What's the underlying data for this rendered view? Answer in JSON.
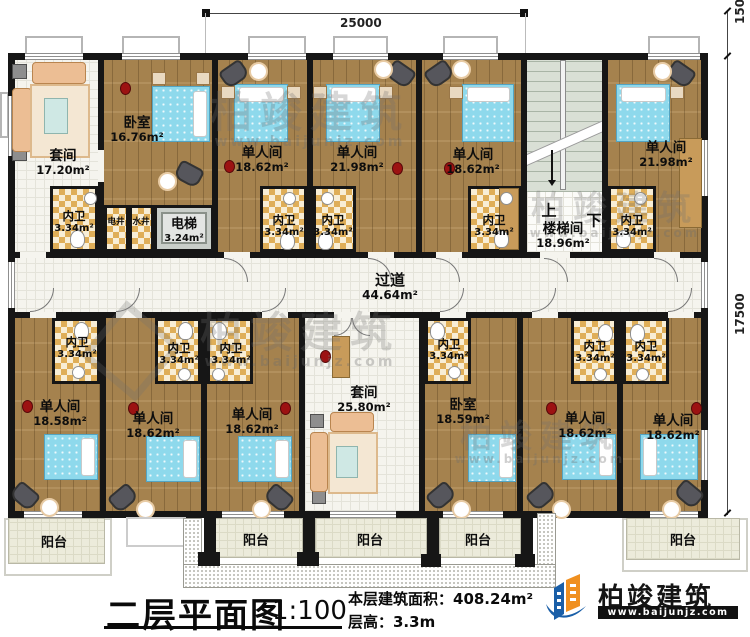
{
  "dims": {
    "width": "25000",
    "right_top": "1500",
    "right_side": "17500"
  },
  "rooms": [
    {
      "name": "套间",
      "area": "17.20m²"
    },
    {
      "name": "卧室",
      "area": "16.76m²"
    },
    {
      "name": "单人间",
      "area": "18.62m²"
    },
    {
      "name": "单人间",
      "area": "21.98m²"
    },
    {
      "name": "单人间",
      "area": "18.62m²"
    },
    {
      "name": "楼梯间",
      "area": "18.96m²"
    },
    {
      "name": "单人间",
      "area": "21.98m²"
    },
    {
      "name": "内卫",
      "area": "3.34m²"
    },
    {
      "name": "电井"
    },
    {
      "name": "水井"
    },
    {
      "name": "电梯",
      "area": "3.24m²"
    },
    {
      "name": "内卫",
      "area": "3.34m²"
    },
    {
      "name": "内卫",
      "area": "3.34m²"
    },
    {
      "name": "内卫",
      "area": "3.34m²"
    },
    {
      "name": "内卫",
      "area": "3.34m²"
    },
    {
      "name": "过道",
      "area": "44.64m²"
    },
    {
      "name": "内卫",
      "area": "3.34m²"
    },
    {
      "name": "内卫",
      "area": "3.34m²"
    },
    {
      "name": "内卫",
      "area": "3.34m²"
    },
    {
      "name": "单人间",
      "area": "18.58m²"
    },
    {
      "name": "单人间",
      "area": "18.62m²"
    },
    {
      "name": "单人间",
      "area": "18.62m²"
    },
    {
      "name": "套间",
      "area": "25.80m²"
    },
    {
      "name": "内卫",
      "area": "3.34m²"
    },
    {
      "name": "卧室",
      "area": "18.59m²"
    },
    {
      "name": "内卫",
      "area": "3.34m²"
    },
    {
      "name": "内卫",
      "area": "3.34m²"
    },
    {
      "name": "单人间",
      "area": "18.62m²"
    },
    {
      "name": "单人间",
      "area": "18.62m²"
    }
  ],
  "balcony": {
    "label": "阳台"
  },
  "stairs": {
    "up": "上",
    "down": "下"
  },
  "title": {
    "text": "二层平面图",
    "scale": "1:100"
  },
  "info": {
    "area": "本层建筑面积：408.24m²",
    "floor_height": "层高：3.3m"
  },
  "brand": {
    "name": "柏竣建筑",
    "site": "www.baijunjz.com"
  },
  "watermark": {
    "text": "柏竣建筑",
    "site": "www.baijunjz.com"
  }
}
